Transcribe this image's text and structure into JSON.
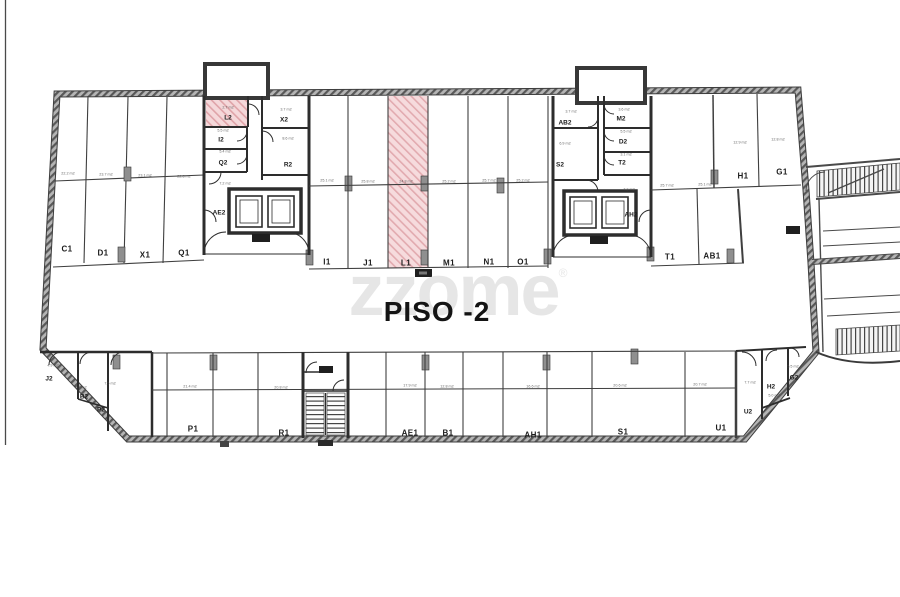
{
  "page": {
    "watermark": "zzome",
    "watermark_symbol": "®"
  },
  "colors": {
    "highlight_fill": "#f5d8da",
    "highlight_hatch": "#dfa3a8",
    "wall": "#3c3c3c"
  },
  "plan": {
    "floor_label": "PISO -2",
    "highlighted_spaces": [
      "L1",
      "L2"
    ],
    "parking_labels": [
      {
        "text": "C1",
        "x": 67,
        "y": 249
      },
      {
        "text": "D1",
        "x": 103,
        "y": 253
      },
      {
        "text": "X1",
        "x": 145,
        "y": 255
      },
      {
        "text": "Q1",
        "x": 184,
        "y": 253
      },
      {
        "text": "I1",
        "x": 327,
        "y": 262
      },
      {
        "text": "J1",
        "x": 368,
        "y": 263
      },
      {
        "text": "L1",
        "x": 406,
        "y": 263
      },
      {
        "text": "M1",
        "x": 449,
        "y": 263
      },
      {
        "text": "N1",
        "x": 489,
        "y": 262
      },
      {
        "text": "O1",
        "x": 523,
        "y": 262
      },
      {
        "text": "T1",
        "x": 670,
        "y": 257
      },
      {
        "text": "AB1",
        "x": 712,
        "y": 256
      },
      {
        "text": "H1",
        "x": 743,
        "y": 176
      },
      {
        "text": "G1",
        "x": 782,
        "y": 172
      },
      {
        "text": "P1",
        "x": 193,
        "y": 429
      },
      {
        "text": "R1",
        "x": 284,
        "y": 433
      },
      {
        "text": "AE1",
        "x": 410,
        "y": 433
      },
      {
        "text": "B1",
        "x": 448,
        "y": 433
      },
      {
        "text": "AH1",
        "x": 533,
        "y": 435
      },
      {
        "text": "S1",
        "x": 623,
        "y": 432
      },
      {
        "text": "U1",
        "x": 721,
        "y": 428
      }
    ],
    "room_labels": [
      {
        "text": "L2",
        "x": 228,
        "y": 118
      },
      {
        "text": "I2",
        "x": 221,
        "y": 140
      },
      {
        "text": "Q2",
        "x": 223,
        "y": 163
      },
      {
        "text": "X2",
        "x": 284,
        "y": 120
      },
      {
        "text": "R2",
        "x": 288,
        "y": 165
      },
      {
        "text": "AE2",
        "x": 219,
        "y": 213
      },
      {
        "text": "AB2",
        "x": 565,
        "y": 123
      },
      {
        "text": "M2",
        "x": 621,
        "y": 119
      },
      {
        "text": "S2",
        "x": 560,
        "y": 165
      },
      {
        "text": "D2",
        "x": 623,
        "y": 142
      },
      {
        "text": "T2",
        "x": 622,
        "y": 163
      },
      {
        "text": "AH2",
        "x": 631,
        "y": 215
      },
      {
        "text": "J2",
        "x": 49,
        "y": 379
      },
      {
        "text": "B2",
        "x": 84,
        "y": 397
      },
      {
        "text": "P2",
        "x": 101,
        "y": 410
      },
      {
        "text": "U2",
        "x": 748,
        "y": 412
      },
      {
        "text": "H2",
        "x": 771,
        "y": 387
      },
      {
        "text": "G2",
        "x": 794,
        "y": 378
      }
    ],
    "area_labels": [
      {
        "text": "22.2 m2",
        "x": 68,
        "y": 174
      },
      {
        "text": "23.7 m2",
        "x": 106,
        "y": 175
      },
      {
        "text": "23.1 m2",
        "x": 145,
        "y": 176
      },
      {
        "text": "22.8 m2",
        "x": 184,
        "y": 177
      },
      {
        "text": "25.1 m2",
        "x": 327,
        "y": 181
      },
      {
        "text": "25.8 m2",
        "x": 368,
        "y": 182
      },
      {
        "text": "24.8 m2",
        "x": 406,
        "y": 182
      },
      {
        "text": "25.2 m2",
        "x": 449,
        "y": 182
      },
      {
        "text": "25.7 m2",
        "x": 489,
        "y": 181
      },
      {
        "text": "25.2 m2",
        "x": 523,
        "y": 181
      },
      {
        "text": "25.7 m2",
        "x": 667,
        "y": 186
      },
      {
        "text": "25.1 m2",
        "x": 705,
        "y": 185
      },
      {
        "text": "12.9 m2",
        "x": 740,
        "y": 143
      },
      {
        "text": "12.8 m2",
        "x": 778,
        "y": 140
      },
      {
        "text": "2.7 m2",
        "x": 228,
        "y": 108
      },
      {
        "text": "3.7 m2",
        "x": 286,
        "y": 110
      },
      {
        "text": "5.5 m2",
        "x": 223,
        "y": 131
      },
      {
        "text": "5.4 m2",
        "x": 225,
        "y": 152
      },
      {
        "text": "8.6 m2",
        "x": 288,
        "y": 139
      },
      {
        "text": "7.2 m2",
        "x": 225,
        "y": 184
      },
      {
        "text": "3.7 m2",
        "x": 571,
        "y": 112
      },
      {
        "text": "3.6 m2",
        "x": 624,
        "y": 110
      },
      {
        "text": "6.9 m2",
        "x": 565,
        "y": 144
      },
      {
        "text": "5.5 m2",
        "x": 626,
        "y": 132
      },
      {
        "text": "3.1 m2",
        "x": 626,
        "y": 155
      },
      {
        "text": "7.2 m2",
        "x": 629,
        "y": 190
      },
      {
        "text": "4.9 m2",
        "x": 53,
        "y": 366
      },
      {
        "text": "5.1 m2",
        "x": 81,
        "y": 388
      },
      {
        "text": "7.5 m2",
        "x": 110,
        "y": 384
      },
      {
        "text": "21.4 m2",
        "x": 190,
        "y": 387
      },
      {
        "text": "20.8 m2",
        "x": 281,
        "y": 388
      },
      {
        "text": "17.9 m2",
        "x": 410,
        "y": 386
      },
      {
        "text": "12.8 m2",
        "x": 447,
        "y": 387
      },
      {
        "text": "16.6 m2",
        "x": 533,
        "y": 387
      },
      {
        "text": "20.6 m2",
        "x": 620,
        "y": 386
      },
      {
        "text": "20.7 m2",
        "x": 700,
        "y": 385
      },
      {
        "text": "7.7 m2",
        "x": 750,
        "y": 383
      },
      {
        "text": "5.0 m2",
        "x": 774,
        "y": 396
      },
      {
        "text": "5.5 m2",
        "x": 793,
        "y": 367
      }
    ]
  }
}
